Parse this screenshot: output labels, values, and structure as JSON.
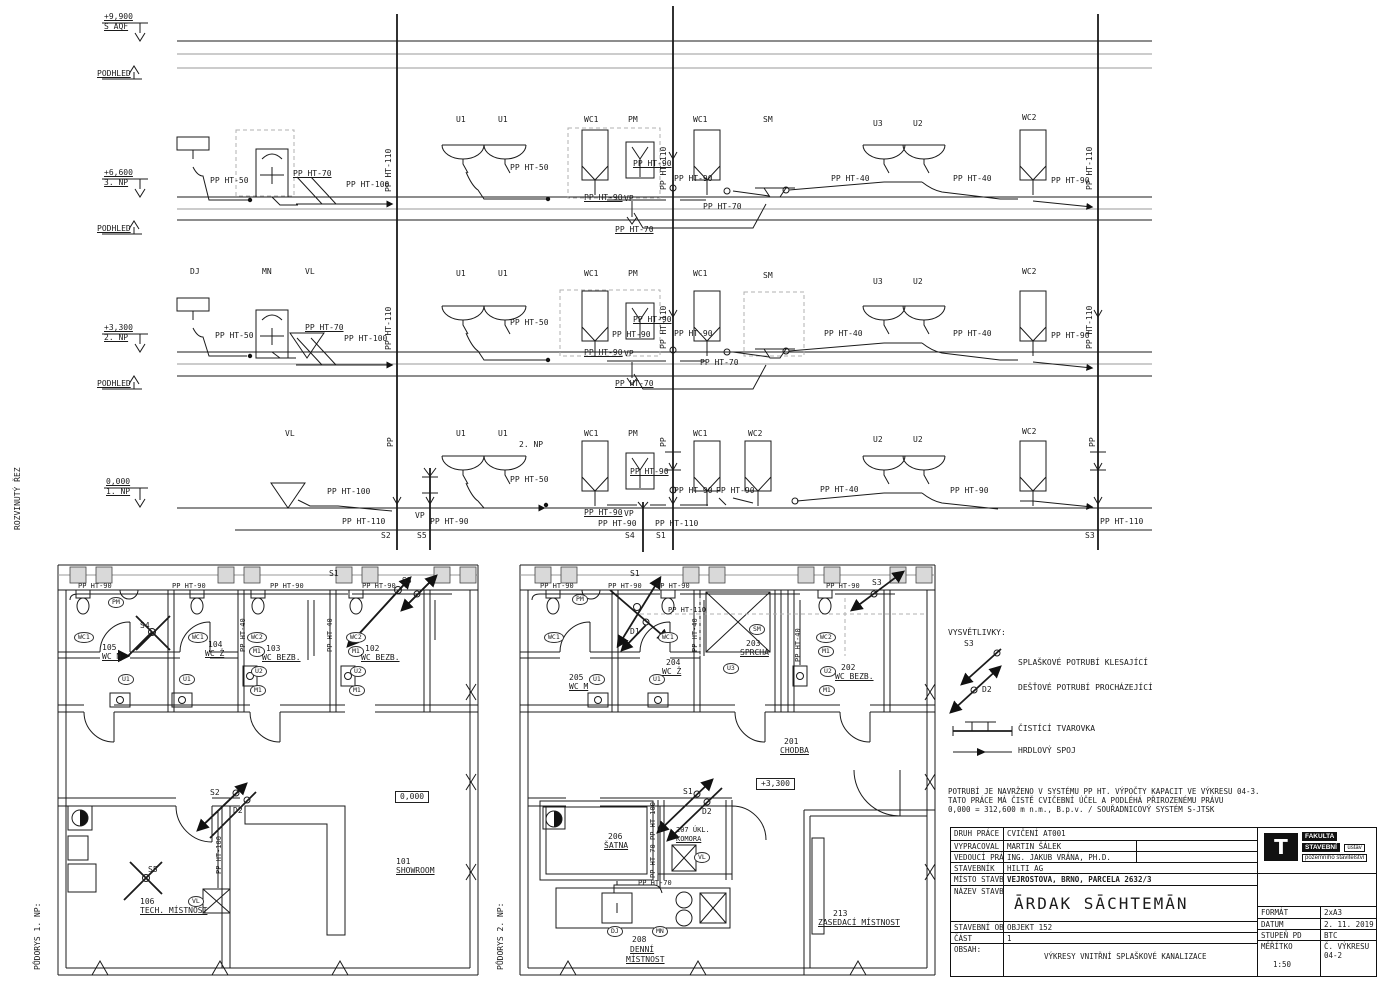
{
  "titles": {
    "section": "ROZVINUTÝ ŘEZ",
    "plan1": "PŮDORYS 1. NP:",
    "plan2": "PŮDORYS 2. NP:"
  },
  "legend": {
    "title": "VYSVĚTLIVKY:",
    "items": [
      {
        "symbol": "descending-sewer-arrow",
        "tag": "S3",
        "label": "SPLAŠKOVÉ POTRUBÍ KLESAJÍCÍ"
      },
      {
        "symbol": "rain-pipe-arrow",
        "tag": "D2",
        "label": "DEŠŤOVÉ POTRUBÍ PROCHÁZEJÍCÍ"
      },
      {
        "symbol": "cleanout-fitting",
        "tag": "",
        "label": "ČISTÍCÍ TVAROVKA"
      },
      {
        "symbol": "socket-joint",
        "tag": "",
        "label": "HRDLOVÝ SPOJ"
      }
    ]
  },
  "notes": [
    "POTRUBÍ JE NAVRŽENO V SYSTÉMU PP HT. VÝPOČTY KAPACIT VE VÝKRESU 04-3.",
    "TATO PRÁCE MÁ ČISTĚ CVIČEBNÍ ÚČEL A PODLÉHÁ PŘIROZENÉMU PRÁVU",
    "0,000 = 312,600 m n.m., B.p.v. / SOUŘADNICOVÝ SYSTÉM S-JTSK"
  ],
  "titleblock": {
    "rows": [
      {
        "label": "DRUH PRÁCE",
        "value": "CVIČENÍ AT001"
      },
      {
        "label": "VYPRACOVAL",
        "value": "MARTIN ŠÁLEK"
      },
      {
        "label": "VEDOUCÍ PRÁCE",
        "value": "ING. JAKUB VRÁNA, PH.D."
      },
      {
        "label": "STAVEBNÍK",
        "value": "HILTI AG"
      },
      {
        "label": "MÍSTO STAVBY",
        "value": "VEJROSTOVA, BRNO, PARCELA 2632/3"
      },
      {
        "label": "NÁZEV STAVBY",
        "value": "ĀRDAK SĀCHTEMĀN"
      },
      {
        "label": "STAVEBNÍ OBJEKT",
        "value": "OBJEKT 152"
      },
      {
        "label": "ČÁST",
        "value": "1"
      },
      {
        "label": "OBSAH:",
        "value": "VÝKRESY VNITŘNÍ SPLAŠKOVÉ KANALIZACE"
      }
    ],
    "meta": {
      "format_label": "FORMÁT",
      "format": "2xA3",
      "datum_label": "DATUM",
      "datum": "2. 11. 2019",
      "stupen_label": "STUPEŇ PD",
      "stupen": "BTC",
      "meritko_label": "MĚŘÍTKO",
      "meritko": "1:50",
      "vykres_label": "Č. VÝKRESU",
      "vykres": "04-2"
    },
    "logo": {
      "t": "T",
      "l1": "FAKULTA",
      "l2": "STAVEBNÍ",
      "l3": "ústav",
      "l4": "pozemního stavitelství"
    }
  },
  "labels": [
    {
      "t": "+9,900",
      "x": 104,
      "y": 13,
      "u": 1
    },
    {
      "t": "S AQF",
      "x": 104,
      "y": 23,
      "u": 1
    },
    {
      "t": "PODHLED",
      "x": 97,
      "y": 70,
      "u": 1
    },
    {
      "t": "+6,600",
      "x": 104,
      "y": 169,
      "u": 1
    },
    {
      "t": "3. NP",
      "x": 104,
      "y": 179,
      "u": 1
    },
    {
      "t": "PODHLED",
      "x": 97,
      "y": 225,
      "u": 1
    },
    {
      "t": "+3,300",
      "x": 104,
      "y": 324,
      "u": 1
    },
    {
      "t": "2. NP",
      "x": 104,
      "y": 334,
      "u": 1
    },
    {
      "t": "PODHLED",
      "x": 97,
      "y": 380,
      "u": 1
    },
    {
      "t": "0,000",
      "x": 106,
      "y": 478,
      "u": 1
    },
    {
      "t": "1. NP",
      "x": 106,
      "y": 488,
      "u": 1
    },
    {
      "t": "ROZVINUTÝ ŘEZ",
      "x": 14,
      "y": 530,
      "r": 1
    },
    {
      "t": "PŮDORYS 1. NP:",
      "x": 34,
      "y": 970,
      "r": 1
    },
    {
      "t": "PŮDORYS 2. NP:",
      "x": 497,
      "y": 970,
      "r": 1
    },
    {
      "t": "U1",
      "x": 456,
      "y": 116
    },
    {
      "t": "U1",
      "x": 498,
      "y": 116
    },
    {
      "t": "WC1",
      "x": 584,
      "y": 116
    },
    {
      "t": "PM",
      "x": 628,
      "y": 116
    },
    {
      "t": "WC1",
      "x": 693,
      "y": 116
    },
    {
      "t": "SM",
      "x": 763,
      "y": 116
    },
    {
      "t": "U3",
      "x": 873,
      "y": 120
    },
    {
      "t": "U2",
      "x": 913,
      "y": 120
    },
    {
      "t": "WC2",
      "x": 1022,
      "y": 114
    },
    {
      "t": "DJ",
      "x": 190,
      "y": 268
    },
    {
      "t": "MN",
      "x": 262,
      "y": 268
    },
    {
      "t": "VL",
      "x": 305,
      "y": 268
    },
    {
      "t": "U1",
      "x": 456,
      "y": 270
    },
    {
      "t": "U1",
      "x": 498,
      "y": 270
    },
    {
      "t": "WC1",
      "x": 584,
      "y": 270
    },
    {
      "t": "PM",
      "x": 628,
      "y": 270
    },
    {
      "t": "WC1",
      "x": 693,
      "y": 270
    },
    {
      "t": "SM",
      "x": 763,
      "y": 272
    },
    {
      "t": "U3",
      "x": 873,
      "y": 278
    },
    {
      "t": "U2",
      "x": 913,
      "y": 278
    },
    {
      "t": "WC2",
      "x": 1022,
      "y": 268
    },
    {
      "t": "VL",
      "x": 285,
      "y": 430
    },
    {
      "t": "U1",
      "x": 456,
      "y": 430
    },
    {
      "t": "U1",
      "x": 498,
      "y": 430
    },
    {
      "t": "2. NP",
      "x": 519,
      "y": 441
    },
    {
      "t": "WC1",
      "x": 584,
      "y": 430
    },
    {
      "t": "PM",
      "x": 628,
      "y": 430
    },
    {
      "t": "WC1",
      "x": 693,
      "y": 430
    },
    {
      "t": "WC2",
      "x": 748,
      "y": 430
    },
    {
      "t": "U2",
      "x": 873,
      "y": 436
    },
    {
      "t": "U2",
      "x": 913,
      "y": 436
    },
    {
      "t": "WC2",
      "x": 1022,
      "y": 428
    },
    {
      "t": "PP HT-50",
      "x": 210,
      "y": 177
    },
    {
      "t": "PP HT-70",
      "x": 293,
      "y": 170,
      "u": 1
    },
    {
      "t": "PP HT-100",
      "x": 346,
      "y": 181
    },
    {
      "t": "PP HT-110",
      "x": 385,
      "y": 192,
      "r": 1
    },
    {
      "t": "PP HT-50",
      "x": 510,
      "y": 164
    },
    {
      "t": "PP HT-90",
      "x": 633,
      "y": 160,
      "u": 1
    },
    {
      "t": "PP HT-110",
      "x": 660,
      "y": 190,
      "r": 1
    },
    {
      "t": "PP HT-90",
      "x": 674,
      "y": 175
    },
    {
      "t": "PP HT-90",
      "x": 584,
      "y": 194,
      "u": 1
    },
    {
      "t": "VP",
      "x": 624,
      "y": 195
    },
    {
      "t": "PP HT-70",
      "x": 703,
      "y": 203
    },
    {
      "t": "PP HT-70",
      "x": 615,
      "y": 226,
      "u": 1
    },
    {
      "t": "PP HT-40",
      "x": 831,
      "y": 175
    },
    {
      "t": "PP HT-40",
      "x": 953,
      "y": 175
    },
    {
      "t": "PP HT-90",
      "x": 1051,
      "y": 177
    },
    {
      "t": "PP HT-110",
      "x": 1086,
      "y": 190,
      "r": 1
    },
    {
      "t": "PP HT-50",
      "x": 215,
      "y": 332
    },
    {
      "t": "PP HT-70",
      "x": 305,
      "y": 324,
      "u": 1
    },
    {
      "t": "PP HT-100",
      "x": 344,
      "y": 335
    },
    {
      "t": "PP HT-110",
      "x": 385,
      "y": 350,
      "r": 1
    },
    {
      "t": "PP HT-50",
      "x": 510,
      "y": 319
    },
    {
      "t": "PP HT-90",
      "x": 633,
      "y": 316,
      "u": 1
    },
    {
      "t": "PP HT-110",
      "x": 660,
      "y": 349,
      "r": 1
    },
    {
      "t": "PP HT-90",
      "x": 612,
      "y": 331
    },
    {
      "t": "PP HT-90",
      "x": 674,
      "y": 330
    },
    {
      "t": "PP HT-90",
      "x": 584,
      "y": 349,
      "u": 1
    },
    {
      "t": "VP",
      "x": 624,
      "y": 350
    },
    {
      "t": "PP HT-70",
      "x": 700,
      "y": 359
    },
    {
      "t": "PP HT-70",
      "x": 615,
      "y": 380,
      "u": 1
    },
    {
      "t": "PP HT-40",
      "x": 824,
      "y": 330
    },
    {
      "t": "PP HT-40",
      "x": 953,
      "y": 330
    },
    {
      "t": "PP HT-90",
      "x": 1051,
      "y": 332
    },
    {
      "t": "PP HT-110",
      "x": 1086,
      "y": 349,
      "r": 1
    },
    {
      "t": "PP",
      "x": 387,
      "y": 447,
      "r": 1
    },
    {
      "t": "PP",
      "x": 660,
      "y": 447,
      "r": 1
    },
    {
      "t": "PP",
      "x": 1089,
      "y": 447,
      "r": 1
    },
    {
      "t": "PP HT-100",
      "x": 327,
      "y": 488
    },
    {
      "t": "PP HT-50",
      "x": 510,
      "y": 476
    },
    {
      "t": "PP HT-90",
      "x": 630,
      "y": 468,
      "u": 1
    },
    {
      "t": "PP HT-90",
      "x": 674,
      "y": 487
    },
    {
      "t": "PP HT-90",
      "x": 716,
      "y": 487
    },
    {
      "t": "PP HT-40",
      "x": 820,
      "y": 486
    },
    {
      "t": "PP HT-90",
      "x": 950,
      "y": 487
    },
    {
      "t": "PP HT-90",
      "x": 584,
      "y": 509,
      "u": 1
    },
    {
      "t": "VP",
      "x": 624,
      "y": 510
    },
    {
      "t": "PP HT-110",
      "x": 342,
      "y": 518
    },
    {
      "t": "VP",
      "x": 415,
      "y": 512
    },
    {
      "t": "PP HT-90",
      "x": 430,
      "y": 518
    },
    {
      "t": "PP HT-90",
      "x": 598,
      "y": 520
    },
    {
      "t": "PP HT-110",
      "x": 655,
      "y": 520
    },
    {
      "t": "PP HT-110",
      "x": 1100,
      "y": 518
    },
    {
      "t": "S2",
      "x": 381,
      "y": 532
    },
    {
      "t": "S5",
      "x": 417,
      "y": 532
    },
    {
      "t": "S4",
      "x": 625,
      "y": 532
    },
    {
      "t": "S1",
      "x": 656,
      "y": 532
    },
    {
      "t": "S3",
      "x": 1085,
      "y": 532
    },
    {
      "t": "S1",
      "x": 329,
      "y": 570
    },
    {
      "t": "S3",
      "x": 402,
      "y": 577
    },
    {
      "t": "S4",
      "x": 140,
      "y": 622
    },
    {
      "t": "PM",
      "x": 108,
      "y": 597,
      "c": 1
    },
    {
      "t": "WC1",
      "x": 74,
      "y": 632,
      "c": 1
    },
    {
      "t": "WC1",
      "x": 188,
      "y": 632,
      "c": 1
    },
    {
      "t": "WC2",
      "x": 247,
      "y": 632,
      "c": 1
    },
    {
      "t": "M1",
      "x": 249,
      "y": 646,
      "c": 1
    },
    {
      "t": "U2",
      "x": 251,
      "y": 666,
      "c": 1
    },
    {
      "t": "M1",
      "x": 250,
      "y": 685,
      "c": 1
    },
    {
      "t": "WC2",
      "x": 346,
      "y": 632,
      "c": 1
    },
    {
      "t": "M1",
      "x": 348,
      "y": 646,
      "c": 1
    },
    {
      "t": "U2",
      "x": 350,
      "y": 666,
      "c": 1
    },
    {
      "t": "M1",
      "x": 349,
      "y": 685,
      "c": 1
    },
    {
      "t": "U1",
      "x": 118,
      "y": 674,
      "c": 1
    },
    {
      "t": "U1",
      "x": 179,
      "y": 674,
      "c": 1
    },
    {
      "t": "105",
      "x": 102,
      "y": 644
    },
    {
      "t": "WC M",
      "x": 102,
      "y": 653,
      "u": 1
    },
    {
      "t": "104",
      "x": 208,
      "y": 641
    },
    {
      "t": "WC Ž",
      "x": 205,
      "y": 650,
      "u": 1
    },
    {
      "t": "103",
      "x": 266,
      "y": 645
    },
    {
      "t": "WC BEZB.",
      "x": 262,
      "y": 654,
      "u": 1
    },
    {
      "t": "102",
      "x": 365,
      "y": 645
    },
    {
      "t": "WC BEZB.",
      "x": 361,
      "y": 654,
      "u": 1
    },
    {
      "t": "PP HT-90",
      "x": 78,
      "y": 583,
      "s": 1
    },
    {
      "t": "PP HT-90",
      "x": 172,
      "y": 583,
      "s": 1
    },
    {
      "t": "PP HT-90",
      "x": 270,
      "y": 583,
      "s": 1
    },
    {
      "t": "PP HT-90",
      "x": 362,
      "y": 583,
      "s": 1
    },
    {
      "t": "PP HT-40",
      "x": 327,
      "y": 652,
      "r": 1,
      "s": 1
    },
    {
      "t": "PP HT-40",
      "x": 240,
      "y": 652,
      "r": 1,
      "s": 1
    },
    {
      "t": "S2",
      "x": 210,
      "y": 789
    },
    {
      "t": "D2",
      "x": 233,
      "y": 807
    },
    {
      "t": "PP HT-100",
      "x": 216,
      "y": 874,
      "r": 1,
      "s": 1
    },
    {
      "t": "S5",
      "x": 148,
      "y": 866
    },
    {
      "t": "VL",
      "x": 188,
      "y": 896,
      "c": 1
    },
    {
      "t": "0,000",
      "x": 395,
      "y": 791,
      "b": 1
    },
    {
      "t": "101",
      "x": 396,
      "y": 858
    },
    {
      "t": "SHOWROOM",
      "x": 396,
      "y": 867,
      "u": 1
    },
    {
      "t": "106",
      "x": 140,
      "y": 898
    },
    {
      "t": "TECH. MÍSTNOST",
      "x": 140,
      "y": 907,
      "u": 1
    },
    {
      "t": "S1",
      "x": 630,
      "y": 570
    },
    {
      "t": "S3",
      "x": 872,
      "y": 579
    },
    {
      "t": "D1",
      "x": 630,
      "y": 628
    },
    {
      "t": "PM",
      "x": 572,
      "y": 594,
      "c": 1
    },
    {
      "t": "WC1",
      "x": 544,
      "y": 632,
      "c": 1
    },
    {
      "t": "WC1",
      "x": 658,
      "y": 632,
      "c": 1
    },
    {
      "t": "SM",
      "x": 749,
      "y": 624,
      "c": 1
    },
    {
      "t": "U3",
      "x": 723,
      "y": 663,
      "c": 1
    },
    {
      "t": "WC2",
      "x": 816,
      "y": 632,
      "c": 1
    },
    {
      "t": "M1",
      "x": 818,
      "y": 646,
      "c": 1
    },
    {
      "t": "U2",
      "x": 820,
      "y": 666,
      "c": 1
    },
    {
      "t": "M1",
      "x": 819,
      "y": 685,
      "c": 1
    },
    {
      "t": "U1",
      "x": 589,
      "y": 674,
      "c": 1
    },
    {
      "t": "U1",
      "x": 649,
      "y": 674,
      "c": 1
    },
    {
      "t": "205",
      "x": 569,
      "y": 674
    },
    {
      "t": "WC M",
      "x": 569,
      "y": 683,
      "u": 1
    },
    {
      "t": "204",
      "x": 666,
      "y": 659
    },
    {
      "t": "WC Ž",
      "x": 662,
      "y": 668,
      "u": 1
    },
    {
      "t": "203",
      "x": 746,
      "y": 640
    },
    {
      "t": "SPRCHA",
      "x": 740,
      "y": 649,
      "u": 1
    },
    {
      "t": "202",
      "x": 841,
      "y": 664
    },
    {
      "t": "WC BEZB.",
      "x": 835,
      "y": 673,
      "u": 1
    },
    {
      "t": "201",
      "x": 784,
      "y": 738
    },
    {
      "t": "CHODBA",
      "x": 780,
      "y": 747,
      "u": 1
    },
    {
      "t": "PP HT-90",
      "x": 540,
      "y": 583,
      "s": 1
    },
    {
      "t": "PP HT-90",
      "x": 608,
      "y": 583,
      "s": 1
    },
    {
      "t": "PP HT-90",
      "x": 656,
      "y": 583,
      "s": 1
    },
    {
      "t": "PP HT-90",
      "x": 826,
      "y": 583,
      "s": 1
    },
    {
      "t": "PP HT-110",
      "x": 668,
      "y": 607,
      "s": 1
    },
    {
      "t": "PP HT-40",
      "x": 692,
      "y": 652,
      "r": 1,
      "s": 1
    },
    {
      "t": "PP HT-40",
      "x": 795,
      "y": 662,
      "r": 1,
      "s": 1
    },
    {
      "t": "S1",
      "x": 683,
      "y": 788
    },
    {
      "t": "D2",
      "x": 702,
      "y": 808
    },
    {
      "t": "+3,300",
      "x": 756,
      "y": 778,
      "b": 1
    },
    {
      "t": "PP HT-100",
      "x": 650,
      "y": 840,
      "r": 1,
      "s": 1
    },
    {
      "t": "PP HT-70",
      "x": 650,
      "y": 878,
      "r": 1,
      "s": 1
    },
    {
      "t": "PP HT-70",
      "x": 638,
      "y": 880,
      "s": 1
    },
    {
      "t": "206",
      "x": 608,
      "y": 833
    },
    {
      "t": "ŠATNA",
      "x": 604,
      "y": 842,
      "u": 1
    },
    {
      "t": "207 ÚKL.",
      "x": 676,
      "y": 827,
      "s": 1
    },
    {
      "t": "KOMORA",
      "x": 676,
      "y": 836,
      "u": 1,
      "s": 1
    },
    {
      "t": "VL",
      "x": 694,
      "y": 852,
      "c": 1
    },
    {
      "t": "DJ",
      "x": 607,
      "y": 926,
      "c": 1
    },
    {
      "t": "MN",
      "x": 652,
      "y": 926,
      "c": 1
    },
    {
      "t": "208",
      "x": 632,
      "y": 936
    },
    {
      "t": "DENNÍ",
      "x": 630,
      "y": 946,
      "u": 1
    },
    {
      "t": "MÍSTNOST",
      "x": 626,
      "y": 956,
      "u": 1
    },
    {
      "t": "213",
      "x": 833,
      "y": 910
    },
    {
      "t": "ZASEDACÍ MÍSTNOST",
      "x": 818,
      "y": 919,
      "u": 1
    },
    {
      "t": "S3",
      "x": 964,
      "y": 640
    },
    {
      "t": "D2",
      "x": 982,
      "y": 686
    }
  ]
}
